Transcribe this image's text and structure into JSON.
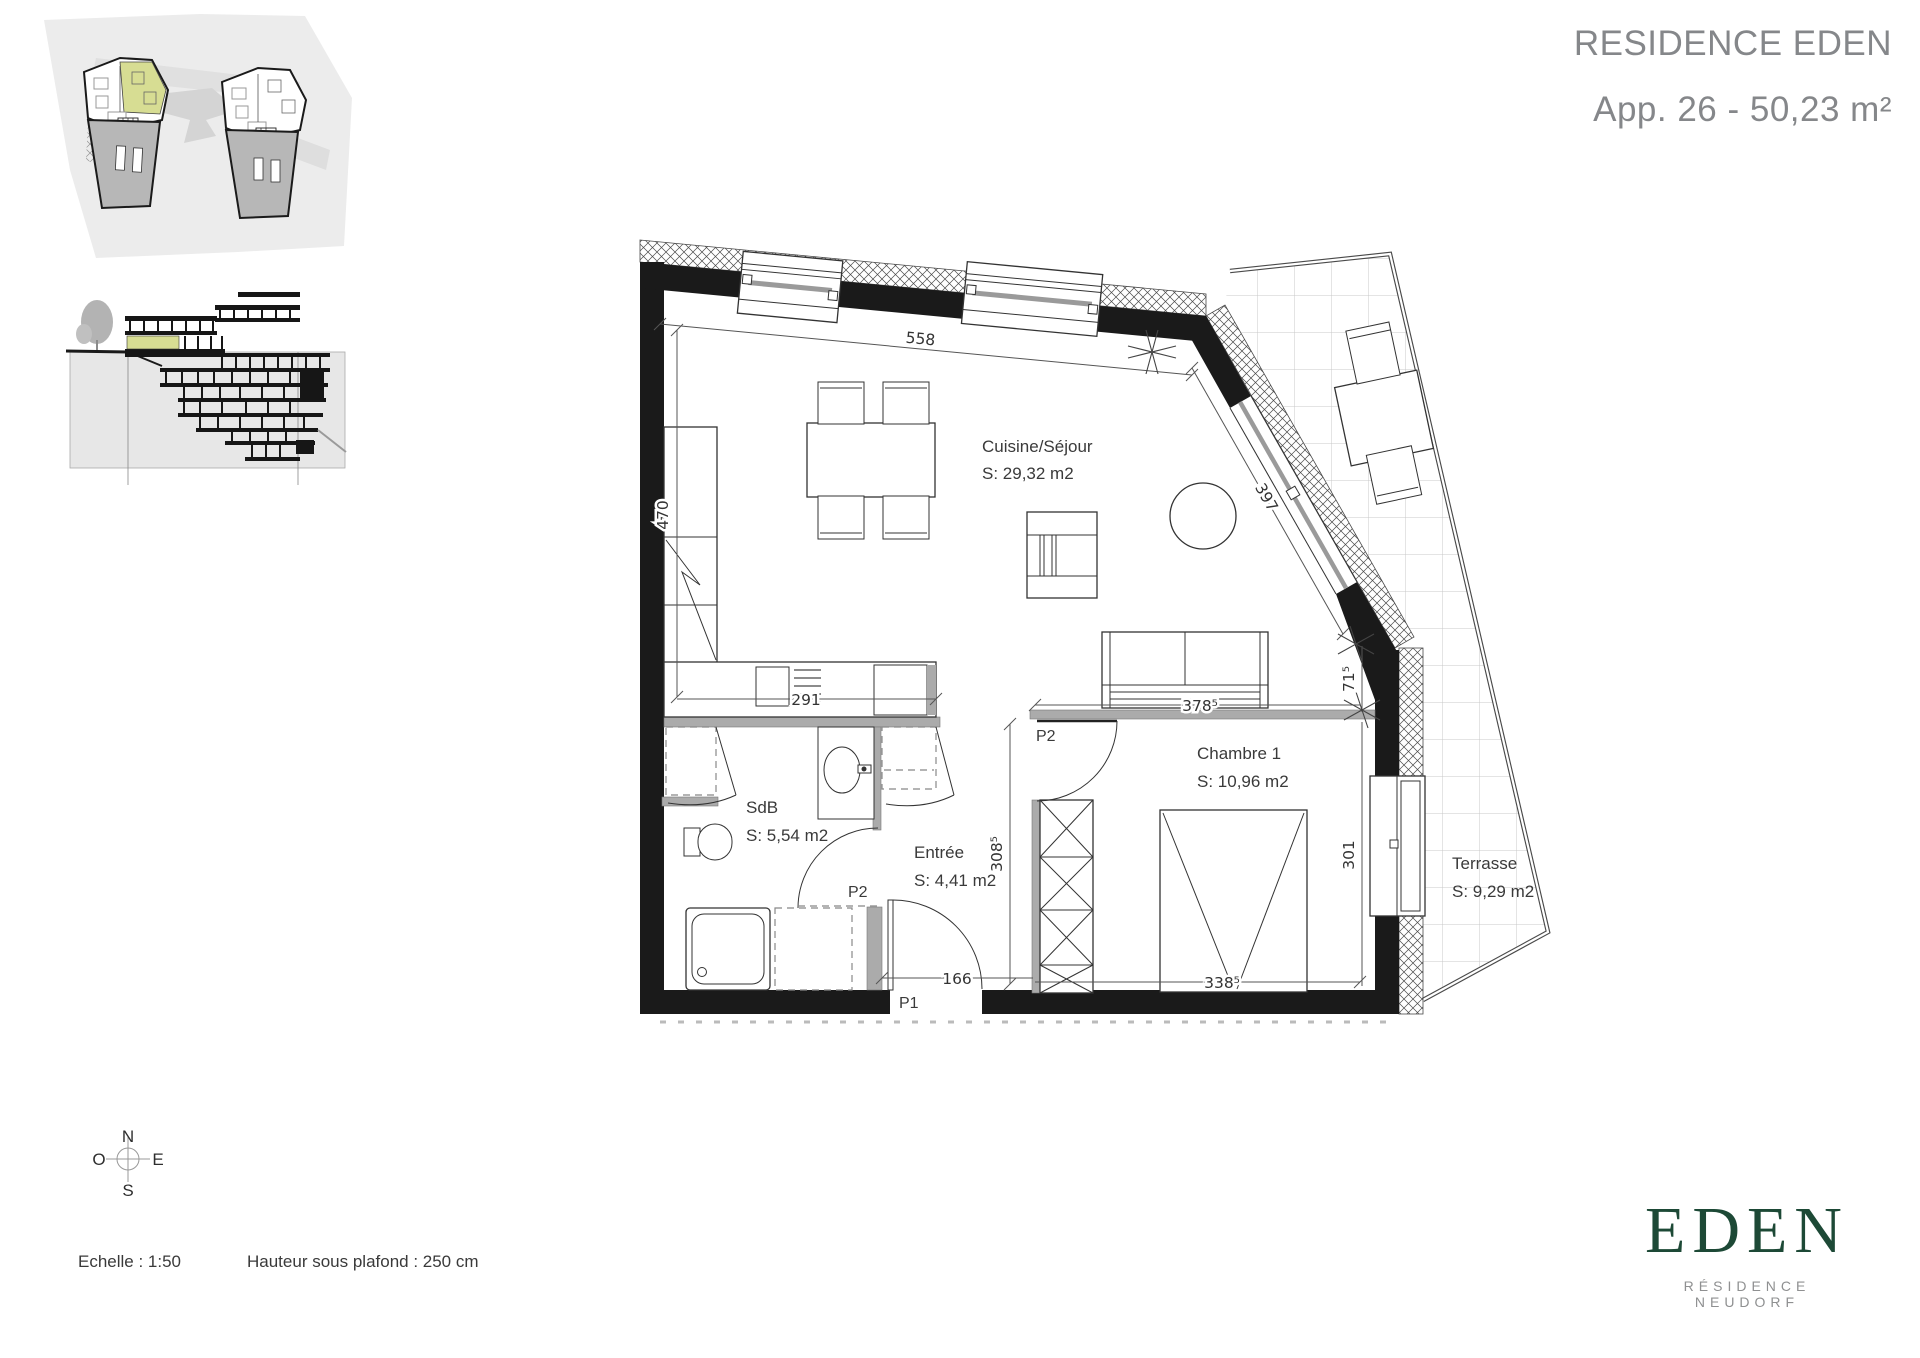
{
  "header": {
    "title": "RESIDENCE EDEN",
    "subtitle": "App. 26 - 50,23 m²"
  },
  "plan": {
    "rooms": {
      "cuisine": {
        "name": "Cuisine/Séjour",
        "area": "S: 29,32 m2"
      },
      "chambre": {
        "name": "Chambre 1",
        "area": "S: 10,96 m2"
      },
      "sdb": {
        "name": "SdB",
        "area": "S: 5,54 m2"
      },
      "entree": {
        "name": "Entrée",
        "area": "S: 4,41 m2"
      },
      "terrasse": {
        "name": "Terrasse",
        "area": "S: 9,29 m2"
      }
    },
    "dims": {
      "top": "558",
      "left": "470",
      "kitchen": "291",
      "bay": "397",
      "jog": "71⁵",
      "sejour_width": "378⁵",
      "entree_height": "308⁵",
      "entree_width": "166",
      "chambre_width": "338⁵",
      "window_right": "301"
    },
    "doors": {
      "p1": "P1",
      "p2_sdb": "P2",
      "p2_chambre": "P2"
    }
  },
  "compass": {
    "n": "N",
    "s": "S",
    "e": "E",
    "o": "O"
  },
  "footer": {
    "scale": "Echelle : 1:50",
    "ceiling": "Hauteur sous plafond : 250 cm"
  },
  "logo": {
    "name": "EDEN",
    "tagline": "RÉSIDENCE NEUDORF"
  },
  "colors": {
    "highlight_green": "#d7dd93",
    "logo_green": "#1d4936",
    "wall_black": "#1a1a1a",
    "partition_gray": "#ababab"
  }
}
